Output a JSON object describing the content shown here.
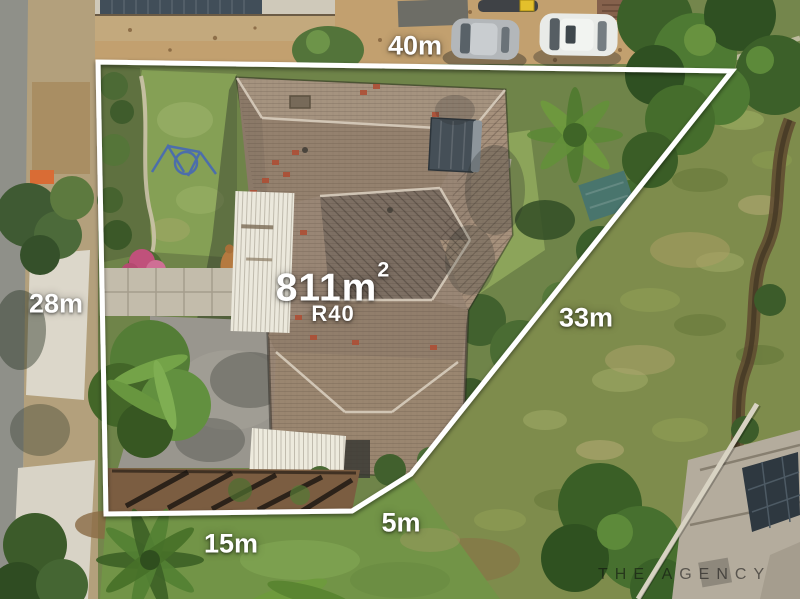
{
  "overlay": {
    "boundary_color": "#ffffff",
    "area": {
      "value": "811m",
      "superscript": "2"
    },
    "zoning": "R40",
    "measurements": {
      "top": "40m",
      "left": "28m",
      "right": "33m",
      "bottom_left": "15m",
      "bottom": "5m"
    }
  },
  "watermark": {
    "text": "THE AGENCY",
    "color": "#1a1a1a"
  },
  "palette": {
    "roof": "#97846f",
    "lawn": "#7f9a55",
    "driveway": "#99968e",
    "hillside": "#7e8c4c",
    "sand_verge": "#c2a06f",
    "boundary": "#ffffff"
  }
}
